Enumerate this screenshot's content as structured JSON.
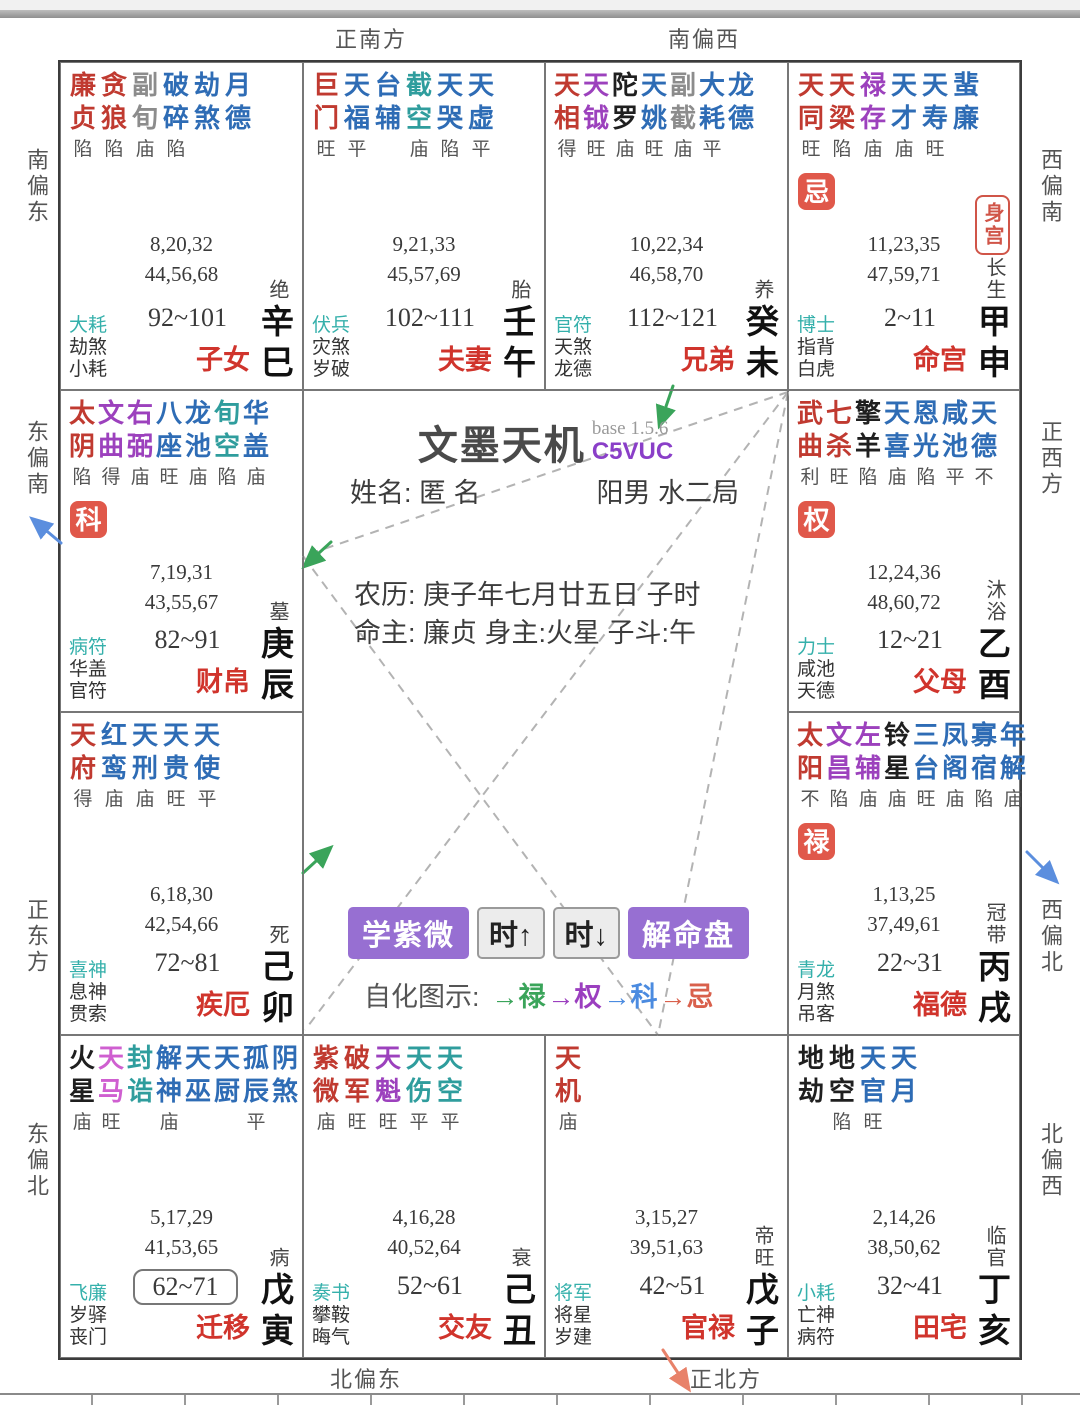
{
  "app": {
    "title": "文墨天机",
    "version": "base 1.5.6",
    "code": "C5VUC"
  },
  "profile": {
    "name_line": "姓名: 匿 名",
    "gender_bureau": "阳男 水二局",
    "lunar_line": "农历: 庚子年七月廿五日 子时",
    "master_line": "命主: 廉贞 身主:火星 子斗:午"
  },
  "toolbar": {
    "buttons": [
      {
        "label": "学紫微",
        "style": "purple"
      },
      {
        "label": "时↑",
        "style": "gray"
      },
      {
        "label": "时↓",
        "style": "gray"
      },
      {
        "label": "解命盘",
        "style": "purple"
      }
    ],
    "legend": {
      "label": "自化图示:",
      "items": [
        {
          "text": "禄",
          "color": "#3aa45a"
        },
        {
          "text": "权",
          "color": "#9b3fbf"
        },
        {
          "text": "科",
          "color": "#4b8be0"
        },
        {
          "text": "忌",
          "color": "#d9604c"
        }
      ]
    }
  },
  "labels": {
    "shengong": "身宫"
  },
  "directions": {
    "top": [
      "正南方",
      "南偏西"
    ],
    "bottom": [
      "北偏东",
      "正北方"
    ],
    "left": [
      "南偏东",
      "东偏南",
      "正东方",
      "东偏北"
    ],
    "right": [
      "西偏南",
      "正西方",
      "西偏北",
      "北偏西"
    ]
  },
  "colors": {
    "major": "#c03a30",
    "lucky": "#9c41bd",
    "magenta": "#cf5fd0",
    "malefic": "#1f1f1f",
    "minor": "#2e6cb5",
    "teal": "#2f9d9d",
    "gray": "#8c8c8c",
    "palace_name": "#d0342c",
    "badge_bg": "#e0584a",
    "god_teal": "#35b0ab",
    "accent_purple": "#976fd2",
    "code_purple": "#8a3fc8",
    "arrow_green": "#3aa45a",
    "arrow_blue": "#5b8ede",
    "arrow_orange": "#e8826a"
  },
  "palaces": [
    {
      "key": "zinv",
      "col": 1,
      "row": 1,
      "name": "子女",
      "branch": "辛巳",
      "stage": "绝",
      "age": "92~101",
      "age_boxed": false,
      "seq1": "8,20,32",
      "seq2": "44,56,68",
      "gods": [
        "大耗",
        "劫煞",
        "小耗"
      ],
      "badge": "",
      "shengong": false,
      "stars": [
        {
          "n": "廉贞",
          "c": "major",
          "b": "陷"
        },
        {
          "n": "贪狼",
          "c": "major",
          "b": "陷"
        },
        {
          "n": "副旬",
          "c": "gray",
          "b": "庙"
        },
        {
          "n": "破碎",
          "c": "minor",
          "b": "陷"
        },
        {
          "n": "劫煞",
          "c": "minor",
          "b": ""
        },
        {
          "n": "月德",
          "c": "minor",
          "b": ""
        }
      ]
    },
    {
      "key": "fuqi",
      "col": 2,
      "row": 1,
      "name": "夫妻",
      "branch": "壬午",
      "stage": "胎",
      "age": "102~111",
      "age_boxed": false,
      "seq1": "9,21,33",
      "seq2": "45,57,69",
      "gods": [
        "伏兵",
        "灾煞",
        "岁破"
      ],
      "badge": "",
      "shengong": false,
      "stars": [
        {
          "n": "巨门",
          "c": "major",
          "b": "旺"
        },
        {
          "n": "天福",
          "c": "minor",
          "b": "平"
        },
        {
          "n": "台辅",
          "c": "minor",
          "b": ""
        },
        {
          "n": "截空",
          "c": "teal",
          "b": "庙"
        },
        {
          "n": "天哭",
          "c": "minor",
          "b": "陷"
        },
        {
          "n": "天虚",
          "c": "minor",
          "b": "平"
        }
      ]
    },
    {
      "key": "xiongdi",
      "col": 3,
      "row": 1,
      "name": "兄弟",
      "branch": "癸未",
      "stage": "养",
      "age": "112~121",
      "age_boxed": false,
      "seq1": "10,22,34",
      "seq2": "46,58,70",
      "gods": [
        "官符",
        "天煞",
        "龙德"
      ],
      "badge": "",
      "shengong": false,
      "stars": [
        {
          "n": "天相",
          "c": "major",
          "b": "得"
        },
        {
          "n": "天钺",
          "c": "lucky",
          "b": "旺"
        },
        {
          "n": "陀罗",
          "c": "malefic",
          "b": "庙"
        },
        {
          "n": "天姚",
          "c": "minor",
          "b": "旺"
        },
        {
          "n": "副截",
          "c": "gray",
          "b": "庙"
        },
        {
          "n": "大耗",
          "c": "minor",
          "b": "平"
        },
        {
          "n": "龙德",
          "c": "minor",
          "b": ""
        }
      ]
    },
    {
      "key": "minggong",
      "col": 4,
      "row": 1,
      "name": "命宫",
      "branch": "甲申",
      "stage": "长生",
      "age": "2~11",
      "age_boxed": false,
      "seq1": "11,23,35",
      "seq2": "47,59,71",
      "gods": [
        "博士",
        "指背",
        "白虎"
      ],
      "badge": "忌",
      "shengong": true,
      "stars": [
        {
          "n": "天同",
          "c": "major",
          "b": "旺"
        },
        {
          "n": "天梁",
          "c": "major",
          "b": "陷"
        },
        {
          "n": "禄存",
          "c": "lucky",
          "b": "庙"
        },
        {
          "n": "天才",
          "c": "minor",
          "b": "庙"
        },
        {
          "n": "天寿",
          "c": "minor",
          "b": "旺"
        },
        {
          "n": "蜚廉",
          "c": "minor",
          "b": ""
        }
      ]
    },
    {
      "key": "caibo",
      "col": 1,
      "row": 2,
      "name": "财帛",
      "branch": "庚辰",
      "stage": "墓",
      "age": "82~91",
      "age_boxed": false,
      "seq1": "7,19,31",
      "seq2": "43,55,67",
      "gods": [
        "病符",
        "华盖",
        "官符"
      ],
      "badge": "科",
      "shengong": false,
      "stars": [
        {
          "n": "太阴",
          "c": "major",
          "b": "陷"
        },
        {
          "n": "文曲",
          "c": "lucky",
          "b": "得"
        },
        {
          "n": "右弼",
          "c": "lucky",
          "b": "庙"
        },
        {
          "n": "八座",
          "c": "minor",
          "b": "旺"
        },
        {
          "n": "龙池",
          "c": "minor",
          "b": "庙"
        },
        {
          "n": "旬空",
          "c": "teal",
          "b": "陷"
        },
        {
          "n": "华盖",
          "c": "minor",
          "b": "庙"
        }
      ]
    },
    {
      "key": "fumu",
      "col": 4,
      "row": 2,
      "name": "父母",
      "branch": "乙酉",
      "stage": "沐浴",
      "age": "12~21",
      "age_boxed": false,
      "seq1": "12,24,36",
      "seq2": "48,60,72",
      "gods": [
        "力士",
        "咸池",
        "天德"
      ],
      "badge": "权",
      "shengong": false,
      "stars": [
        {
          "n": "武曲",
          "c": "major",
          "b": "利"
        },
        {
          "n": "七杀",
          "c": "major",
          "b": "旺"
        },
        {
          "n": "擎羊",
          "c": "malefic",
          "b": "陷"
        },
        {
          "n": "天喜",
          "c": "minor",
          "b": "庙"
        },
        {
          "n": "恩光",
          "c": "minor",
          "b": "陷"
        },
        {
          "n": "咸池",
          "c": "minor",
          "b": "平"
        },
        {
          "n": "天德",
          "c": "minor",
          "b": "不"
        }
      ]
    },
    {
      "key": "jie",
      "col": 1,
      "row": 3,
      "name": "疾厄",
      "branch": "己卯",
      "stage": "死",
      "age": "72~81",
      "age_boxed": false,
      "seq1": "6,18,30",
      "seq2": "42,54,66",
      "gods": [
        "喜神",
        "息神",
        "贯索"
      ],
      "badge": "",
      "shengong": false,
      "stars": [
        {
          "n": "天府",
          "c": "major",
          "b": "得"
        },
        {
          "n": "红鸾",
          "c": "minor",
          "b": "庙"
        },
        {
          "n": "天刑",
          "c": "minor",
          "b": "庙"
        },
        {
          "n": "天贵",
          "c": "minor",
          "b": "旺"
        },
        {
          "n": "天使",
          "c": "minor",
          "b": "平"
        }
      ]
    },
    {
      "key": "fude",
      "col": 4,
      "row": 3,
      "name": "福德",
      "branch": "丙戌",
      "stage": "冠带",
      "age": "22~31",
      "age_boxed": false,
      "seq1": "1,13,25",
      "seq2": "37,49,61",
      "gods": [
        "青龙",
        "月煞",
        "吊客"
      ],
      "badge": "禄",
      "shengong": false,
      "stars": [
        {
          "n": "太阳",
          "c": "major",
          "b": "不"
        },
        {
          "n": "文昌",
          "c": "lucky",
          "b": "陷"
        },
        {
          "n": "左辅",
          "c": "lucky",
          "b": "庙"
        },
        {
          "n": "铃星",
          "c": "malefic",
          "b": "庙"
        },
        {
          "n": "三台",
          "c": "minor",
          "b": "旺"
        },
        {
          "n": "凤阁",
          "c": "minor",
          "b": "庙"
        },
        {
          "n": "寡宿",
          "c": "minor",
          "b": "陷"
        },
        {
          "n": "年解",
          "c": "minor",
          "b": "庙"
        }
      ]
    },
    {
      "key": "qianyi",
      "col": 1,
      "row": 4,
      "name": "迁移",
      "branch": "戊寅",
      "stage": "病",
      "age": "62~71",
      "age_boxed": true,
      "seq1": "5,17,29",
      "seq2": "41,53,65",
      "gods": [
        "飞廉",
        "岁驿",
        "丧门"
      ],
      "badge": "",
      "shengong": false,
      "stars": [
        {
          "n": "火星",
          "c": "malefic",
          "b": "庙"
        },
        {
          "n": "天马",
          "c": "magenta",
          "b": "旺"
        },
        {
          "n": "封诰",
          "c": "teal",
          "b": ""
        },
        {
          "n": "解神",
          "c": "minor",
          "b": "庙"
        },
        {
          "n": "天巫",
          "c": "minor",
          "b": ""
        },
        {
          "n": "天厨",
          "c": "minor",
          "b": ""
        },
        {
          "n": "孤辰",
          "c": "minor",
          "b": "平"
        },
        {
          "n": "阴煞",
          "c": "minor",
          "b": ""
        }
      ]
    },
    {
      "key": "jiaoyou",
      "col": 2,
      "row": 4,
      "name": "交友",
      "branch": "己丑",
      "stage": "衰",
      "age": "52~61",
      "age_boxed": false,
      "seq1": "4,16,28",
      "seq2": "40,52,64",
      "gods": [
        "奏书",
        "攀鞍",
        "晦气"
      ],
      "badge": "",
      "shengong": false,
      "stars": [
        {
          "n": "紫微",
          "c": "major",
          "b": "庙"
        },
        {
          "n": "破军",
          "c": "major",
          "b": "旺"
        },
        {
          "n": "天魁",
          "c": "lucky",
          "b": "旺"
        },
        {
          "n": "天伤",
          "c": "teal",
          "b": "平"
        },
        {
          "n": "天空",
          "c": "teal",
          "b": "平"
        }
      ]
    },
    {
      "key": "guanlu",
      "col": 3,
      "row": 4,
      "name": "官禄",
      "branch": "戊子",
      "stage": "帝旺",
      "age": "42~51",
      "age_boxed": false,
      "seq1": "3,15,27",
      "seq2": "39,51,63",
      "gods": [
        "将军",
        "将星",
        "岁建"
      ],
      "badge": "",
      "shengong": false,
      "stars": [
        {
          "n": "天机",
          "c": "major",
          "b": "庙"
        }
      ]
    },
    {
      "key": "tianzhai",
      "col": 4,
      "row": 4,
      "name": "田宅",
      "branch": "丁亥",
      "stage": "临官",
      "age": "32~41",
      "age_boxed": false,
      "seq1": "2,14,26",
      "seq2": "38,50,62",
      "gods": [
        "小耗",
        "亡神",
        "病符"
      ],
      "badge": "",
      "shengong": false,
      "stars": [
        {
          "n": "地劫",
          "c": "malefic",
          "b": ""
        },
        {
          "n": "地空",
          "c": "malefic",
          "b": "陷"
        },
        {
          "n": "天官",
          "c": "minor",
          "b": "旺"
        },
        {
          "n": "天月",
          "c": "minor",
          "b": ""
        }
      ]
    }
  ]
}
